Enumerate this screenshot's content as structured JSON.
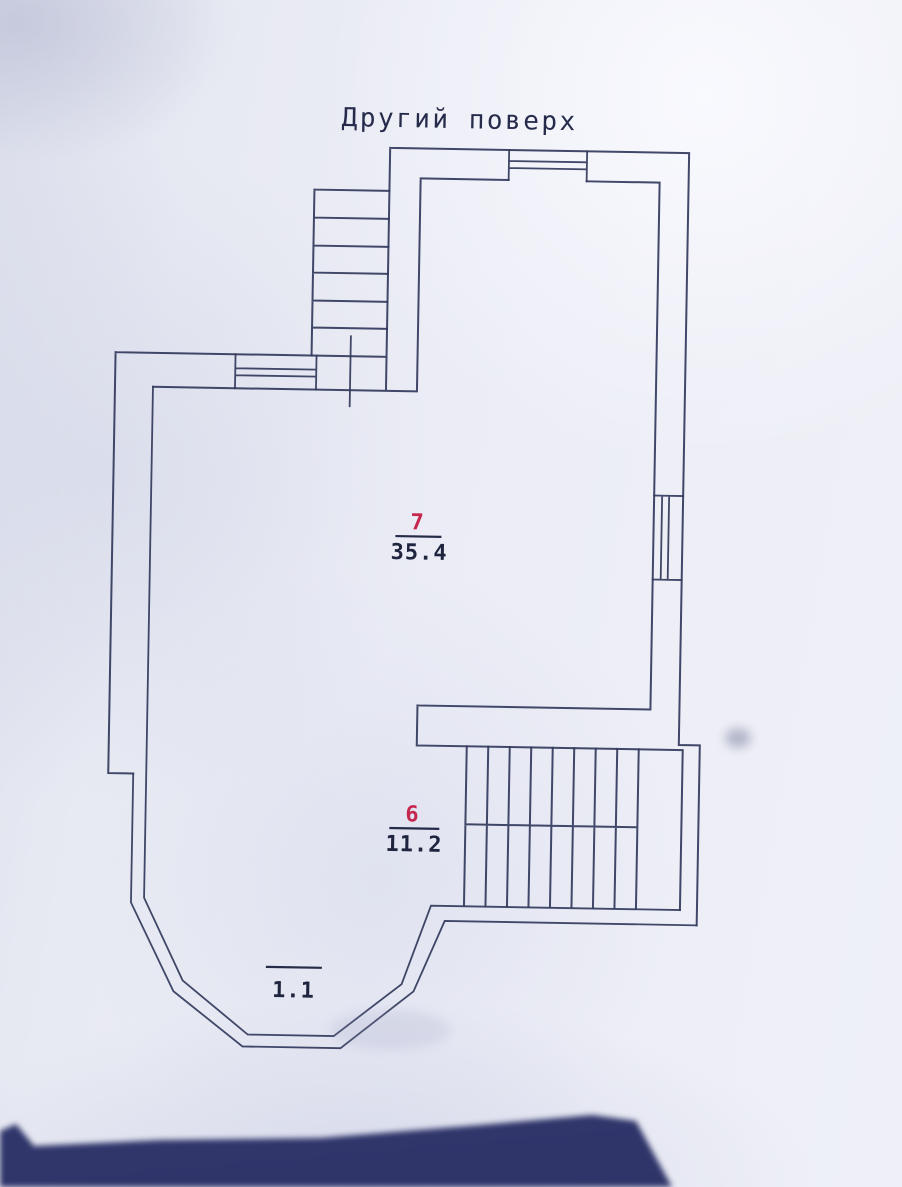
{
  "title": "Другий поверх",
  "labels": {
    "room7": {
      "number": "7",
      "area": "35.4"
    },
    "room6": {
      "number": "6",
      "area": "11.2"
    },
    "balcony": {
      "area": "1.1"
    }
  },
  "features": {
    "staircase_top": "exterior-staircase",
    "staircase_main": "interior-staircase-with-rail",
    "windows": 3,
    "bay": "polygonal-bay-window"
  },
  "colors": {
    "paper": "#eaecf5",
    "ink": "#333a5d",
    "room_number_red": "#c5274e",
    "label_dark": "#20253f",
    "dark_object": "#3c4277"
  }
}
